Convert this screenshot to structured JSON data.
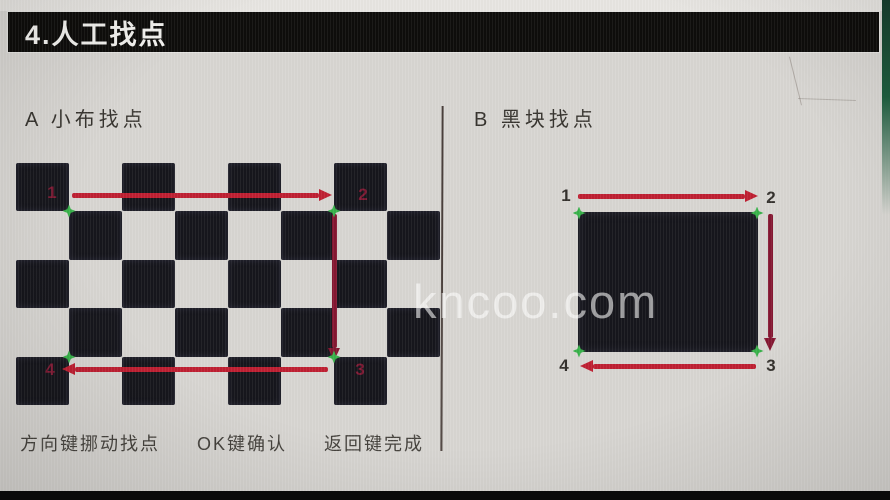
{
  "window": {
    "title": "4.人工找点"
  },
  "watermark": "kncoo.com",
  "sections": {
    "a": {
      "header": "A 小布找点",
      "points": [
        "1",
        "2",
        "3",
        "4"
      ]
    },
    "b": {
      "header": "B 黑块找点",
      "points": [
        "1",
        "2",
        "3",
        "4"
      ]
    }
  },
  "footer": {
    "hints": [
      "方向键挪动找点",
      "OK键确认",
      "返回键完成"
    ]
  },
  "checkerboard": {
    "rows": 5,
    "cols": 8,
    "black_when": "row+col even"
  },
  "colors": {
    "accent_red": "#bf1f32",
    "accent_red_dark": "#851732",
    "marker_green": "#38b24a",
    "point_label_dark_red": "#7e1a34",
    "point_label_black": "#34312d",
    "square_black": "#16161c",
    "title_bar_black": "#0e0d0b"
  }
}
